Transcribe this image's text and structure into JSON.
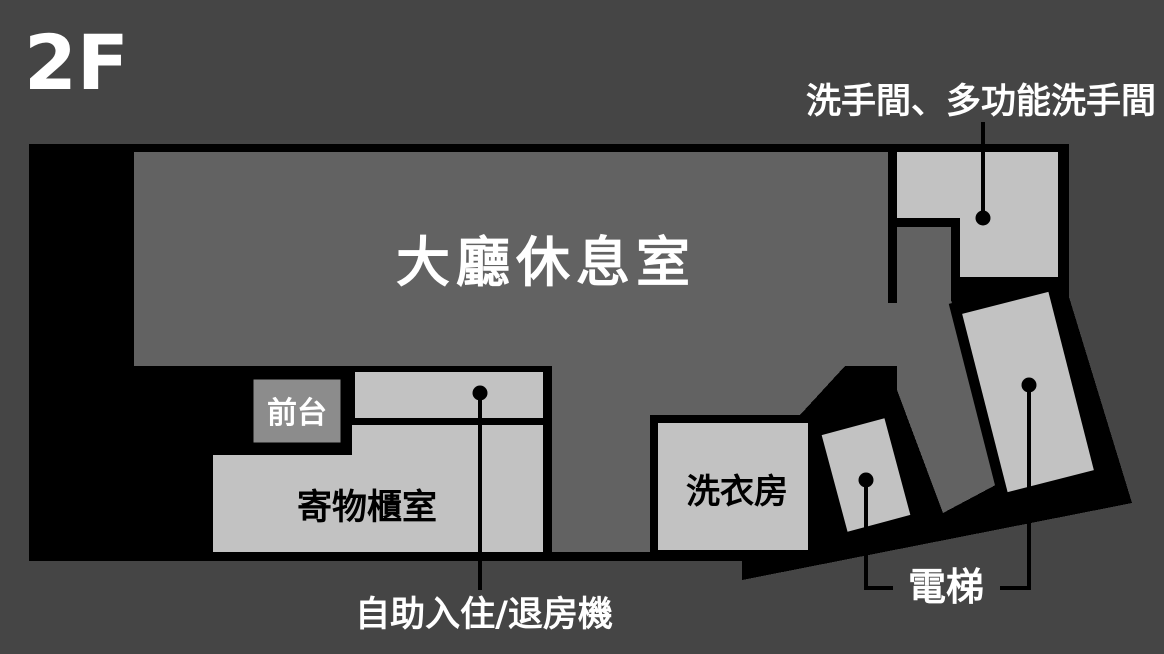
{
  "floor_indicator": "2F",
  "rooms": {
    "lobby": "大廳休息室",
    "front_desk": "前台",
    "locker": "寄物櫃室",
    "laundry": "洗衣房"
  },
  "callouts": {
    "restroom": "洗手間、多功能洗手間",
    "kiosk": "自助入住/退房機",
    "elevator": "電梯"
  },
  "colors": {
    "background": "#454545",
    "building_outline": "#000000",
    "floor": "#626262",
    "room": "#c2c2c2",
    "front_desk": "#8c8c8c",
    "label_light": "#ffffff",
    "label_dark": "#000000"
  }
}
